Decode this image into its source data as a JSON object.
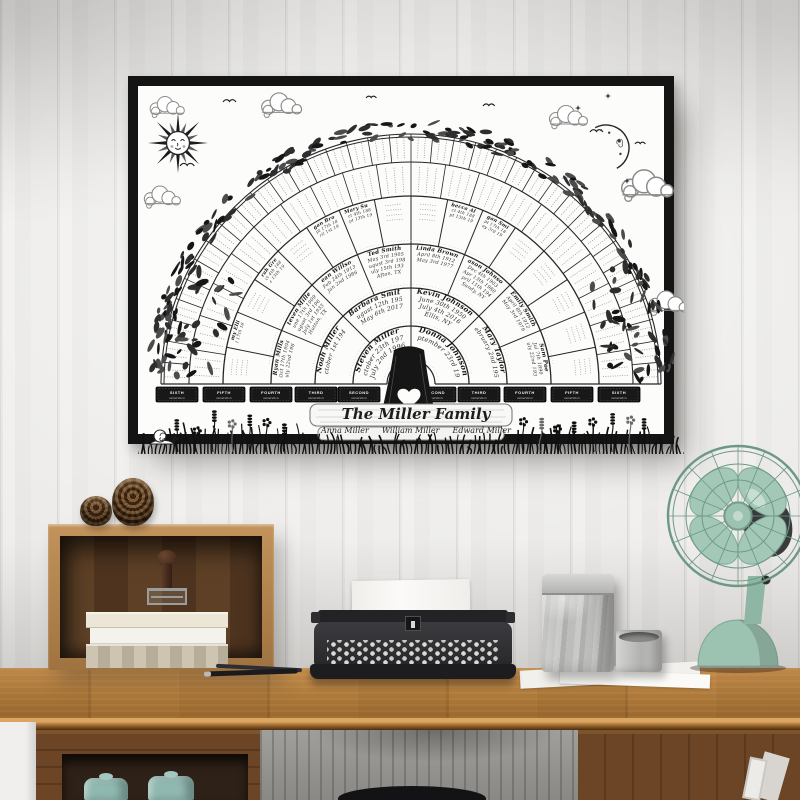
{
  "poster": {
    "title": "The Miller Family",
    "family_names": [
      "Anna Miller",
      "William Miller",
      "Edward Miller"
    ],
    "generation_word": "Generation",
    "ribbons_left": [
      "SIXTH",
      "FIFTH",
      "FOURTH",
      "THIRD",
      "SECOND"
    ],
    "ribbons_right": [
      "SECOND",
      "THIRD",
      "FOURTH",
      "FIFTH",
      "SIXTH"
    ],
    "fan_rings": [
      {
        "generation": "first",
        "cells": [
          [
            "Steven Miller",
            "October 23th 1973",
            "July 2nd 1996"
          ],
          [
            "Donna Johnson",
            "September 23rd 1980"
          ]
        ]
      },
      {
        "generation": "second",
        "cells": [
          [
            "Noah Miller",
            "October 1st 1948"
          ],
          [
            "Barbara Smith",
            "August 12th 1950",
            "May 6th 2017"
          ],
          [
            "Kevin Johnson",
            "June 30th 1950",
            "July 4th 2016",
            "Ellis, NY"
          ],
          [
            "Mary Taylor",
            "February 2nd 1952"
          ]
        ]
      },
      {
        "generation": "third",
        "cells": [
          [
            "Ryan Mills",
            "Oct 17th 1904",
            "July 22nd 1980"
          ],
          [
            "Steven Miller",
            "June 17th 1909",
            "August 3rd 1963",
            "July 1st 1933",
            "Hutton, TX"
          ],
          [
            "Dean Willson",
            "Feb 24th 1913",
            "Jan 2nd 1986"
          ],
          [
            "Ted Smith",
            "May 3rd 1905",
            "August 3rd 1987",
            "July 15th 1930",
            "Afton, TX"
          ],
          [
            "Linda Brown",
            "April 8th 1912",
            "May 3rd 1977"
          ],
          [
            "Jason Johnson",
            "Dec 4th 1903",
            "Apr 13th 1980",
            "April 11th 1944",
            "Sandy, NY"
          ],
          [
            "Emily Smith",
            "April 8th 1912",
            "May 3rd 1979"
          ],
          [
            "Sam Poe",
            "Jul 7th 1890",
            "July 22nd 1930"
          ]
        ]
      },
      {
        "generation": "fourth",
        "cells": [
          [],
          [
            "Amy Ellis",
            "Jul 17th 1887"
          ],
          [],
          [
            "Sarah Green",
            "Oct 4th 1883",
            "Dec 13th 1919"
          ],
          [],
          [
            "Logan Brown",
            "Sept 17th 1884",
            "April 1st 1900"
          ],
          [
            "Mary Sue",
            "Oct 4th 1884",
            "Sept 13th 1919"
          ],
          [],
          [],
          [
            "Rebecca Allen",
            "Oct 4th 1884",
            "Sept 13th 1910"
          ],
          [
            "Logan Smith",
            "Sept 17th 1884",
            "May 3rd 1919"
          ],
          [],
          [],
          [],
          [],
          []
        ]
      },
      {
        "generation": "fifth",
        "cells": []
      },
      {
        "generation": "sixth",
        "cells": []
      }
    ]
  },
  "colors": {
    "frame_black": "#141414",
    "poster_white": "#fcfcfb",
    "ink_black": "#1c1c1c",
    "desk_wood": "#b5803f",
    "fan_mint": "#9cc2b1",
    "jar_teal": "#8fb8b0",
    "canister_silver": "#bdbdbb"
  }
}
